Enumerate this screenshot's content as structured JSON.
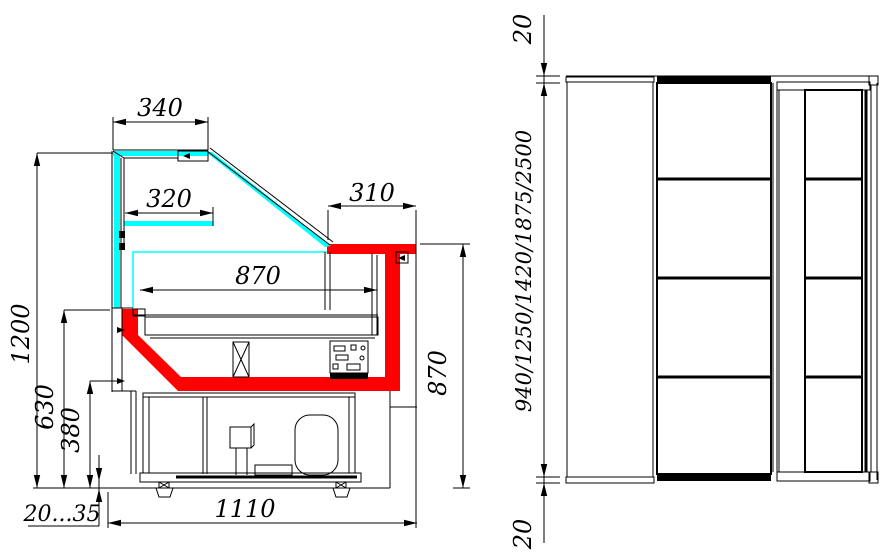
{
  "drawing": {
    "colors": {
      "glass": "#00ffff",
      "front_accent": "#ff0000",
      "line": "#000000",
      "background": "#ffffff"
    },
    "side_view": {
      "dims": {
        "canopy_width": "340",
        "shelf_width": "320",
        "worktop_width": "310",
        "well_width": "870",
        "overall_height": "1200",
        "counter_height": "630",
        "base_height": "380",
        "front_height": "870",
        "foot_adjustment": "20...35",
        "base_width": "1110"
      }
    },
    "plan_view": {
      "dims": {
        "top_overhang": "20",
        "length_options": "940/1250/1420/1875/2500",
        "bottom_overhang": "20"
      }
    }
  }
}
